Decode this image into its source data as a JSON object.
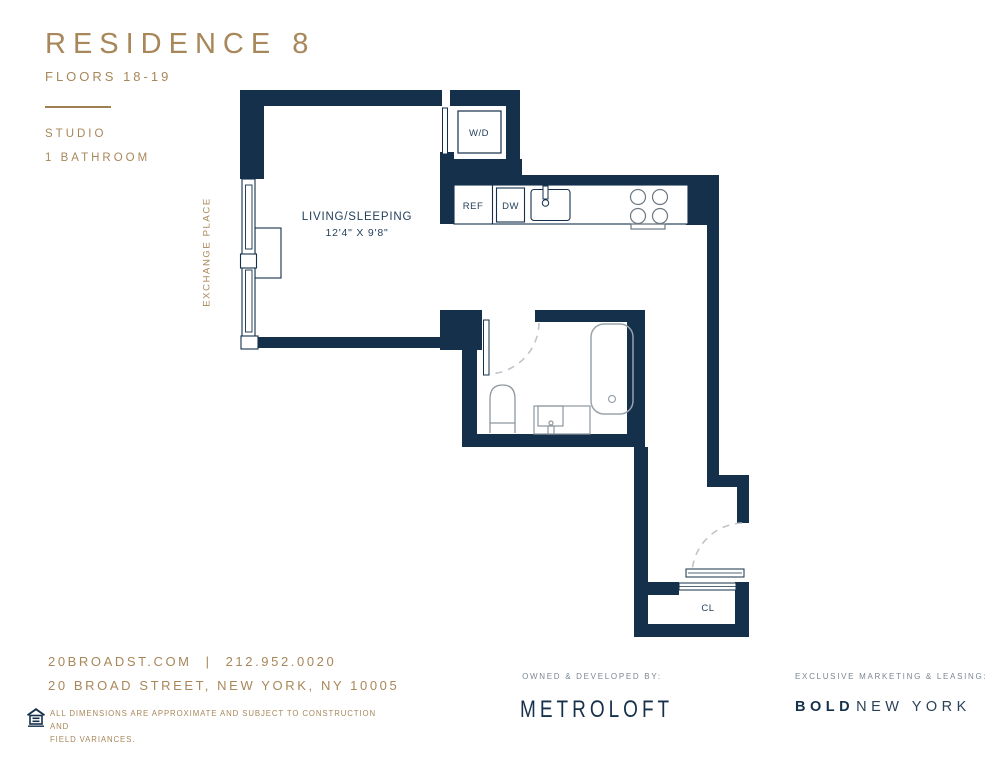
{
  "colors": {
    "navy_wall": "#15304a",
    "gold": "#a8875a",
    "fixture_gray": "#939ca4",
    "arc_gray": "#bfc5cb",
    "credit_gray": "#7c8692"
  },
  "header": {
    "title": "RESIDENCE 8",
    "subtitle": "FLOORS 18-19",
    "unit_type": "STUDIO",
    "bathrooms": "1 BATHROOM"
  },
  "plan": {
    "street_label": "EXCHANGE PLACE",
    "living_room": {
      "name": "LIVING/SLEEPING",
      "dimensions": "12'4\" X 9'8\""
    },
    "labels": {
      "washer_dryer": "W/D",
      "refrigerator": "REF",
      "dishwasher": "DW",
      "closet": "CL"
    }
  },
  "footer": {
    "website": "20BROADST.COM",
    "separator": "|",
    "phone": "212.952.0020",
    "address": "20 BROAD STREET, NEW YORK, NY 10005",
    "disclaimer_line1": "ALL DIMENSIONS ARE APPROXIMATE AND SUBJECT TO CONSTRUCTION AND",
    "disclaimer_line2": "FIELD VARIANCES.",
    "developer": {
      "label": "OWNED & DEVELOPED BY:",
      "name": "METROLOFT"
    },
    "marketing": {
      "label": "EXCLUSIVE MARKETING & LEASING:",
      "name_bold": "BOLD",
      "name_rest": "NEW YORK"
    }
  }
}
